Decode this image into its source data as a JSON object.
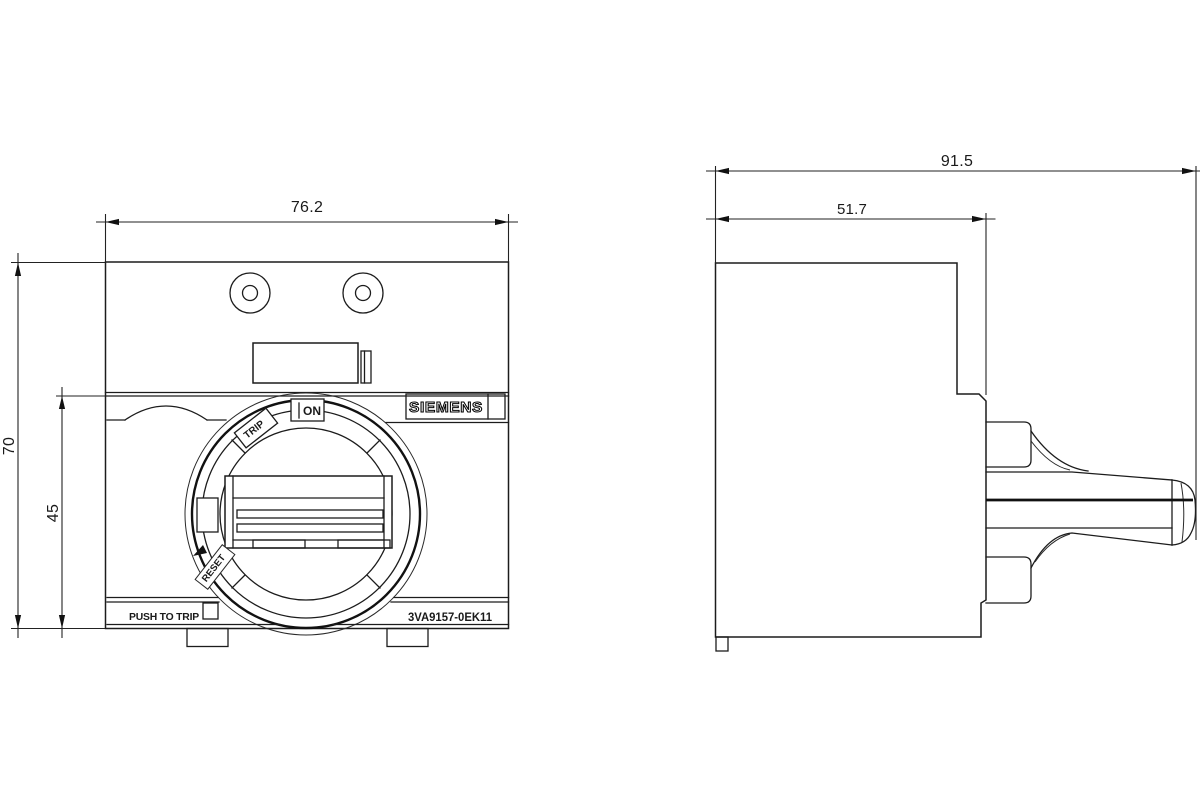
{
  "drawing": {
    "background": "#ffffff",
    "line_color": "#1c1c1c",
    "views": {
      "front": {
        "dim_width_mm": "76.2",
        "dim_height_mm": "70",
        "dim_lower_height_mm": "45",
        "brand_label": "SIEMENS",
        "dial": {
          "on_label": "ON",
          "trip_label": "TRIP",
          "reset_label": "RESET"
        },
        "push_to_trip_label": "PUSH TO TRIP",
        "part_number": "3VA9157-0EK11"
      },
      "side": {
        "dim_total_depth_mm": "91.5",
        "dim_body_depth_mm": "51.7"
      }
    }
  }
}
